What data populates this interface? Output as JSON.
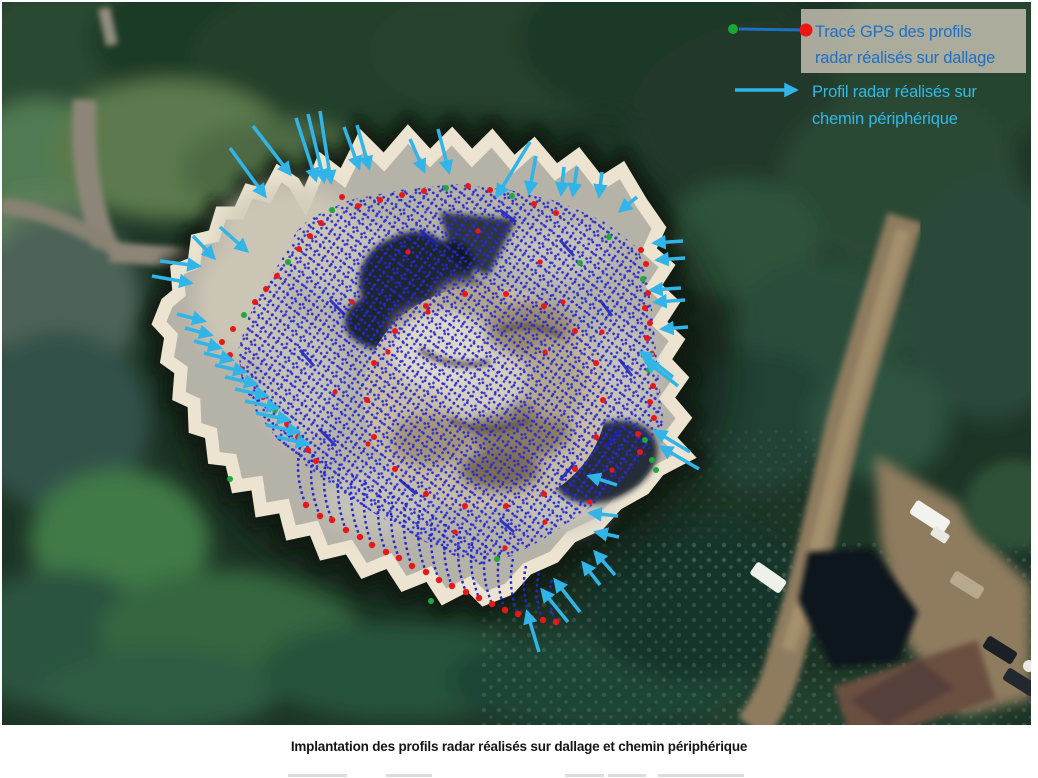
{
  "figure": {
    "legend": {
      "item1": {
        "line1": "Tracé GPS des profils",
        "line2": "radar réalisés sur dallage",
        "text_color": "#1E6FC4",
        "marker": "red-dot-with-line-from-green-dot"
      },
      "item2": {
        "line1": "Profil radar réalisés sur",
        "line2": "chemin périphérique",
        "text_color": "#2FB9EA",
        "marker": "cyan-arrow"
      }
    },
    "caption": "Implantation des profils radar réalisés sur dallage et chemin périphérique",
    "colors": {
      "trace_blue": "#2326CF",
      "endpoint_red": "#E81818",
      "endpoint_green": "#1FA83C",
      "arrow_cyan": "#31B4E8"
    }
  }
}
